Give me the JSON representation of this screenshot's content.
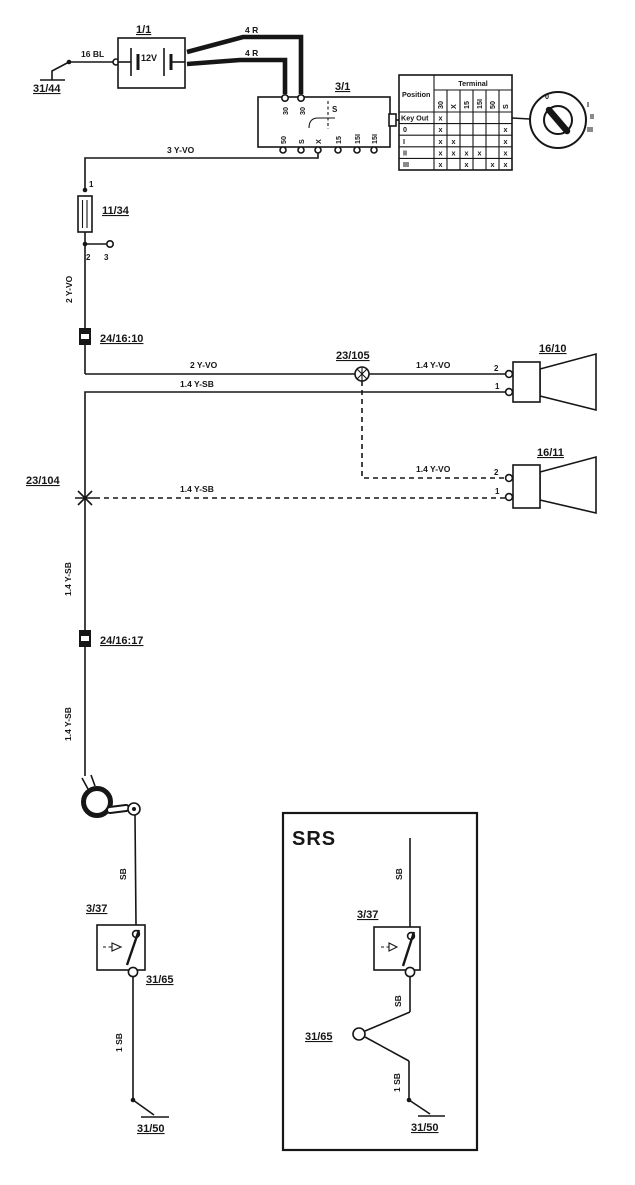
{
  "page": {
    "bg": "#ffffff",
    "ink": "#161616"
  },
  "labels": {
    "ground_top_left": "31/44",
    "wire_16bl": "16 BL",
    "battery_id": "1/1",
    "battery_voltage": "12V",
    "wire_4r_upper": "4 R",
    "wire_4r_lower": "4 R",
    "ignition_id": "3/1",
    "ignition_top_terminals": [
      "30",
      "30"
    ],
    "ignition_internal_s": "S",
    "ignition_bottom_terminals": [
      "50",
      "S",
      "X",
      "15",
      "15I",
      "15I"
    ],
    "wire_3yvo": "3 Y-VO",
    "fuse_terminal_1": "1",
    "fuse_id": "11/34",
    "fuse_terminal_2": "2",
    "fuse_terminal_3": "3",
    "wire_2yvo_vertical": "2 Y-VO",
    "connector_24_16_10": "24/16:10",
    "wire_2yvo": "2 Y-VO",
    "splice_23_105": "23/105",
    "wire_14yvo_solid": "1.4 Y-VO",
    "horn_upper_id": "16/10",
    "horn_upper_terminal_2": "2",
    "horn_upper_terminal_1": "1",
    "wire_14ysb_solid": "1.4 Y-SB",
    "wire_14yvo_dashed": "1.4 Y-VO",
    "horn_lower_id": "16/11",
    "horn_lower_terminal_2": "2",
    "horn_lower_terminal_1": "1",
    "splice_23_104": "23/104",
    "wire_14ysb_dashed": "1.4 Y-SB",
    "wire_14ysb_upper": "1.4 Y-SB",
    "connector_24_16_17": "24/16:17",
    "wire_14ysb_lower": "1.4 Y-SB",
    "wire_sb_left": "SB",
    "switch_left_id": "3/37",
    "connector_31_65_left": "31/65",
    "wire_1sb_left": "1 SB",
    "ground_bottom_left": "31/50"
  },
  "table": {
    "position_header": "Position",
    "terminal_header": "Terminal",
    "columns": [
      "30",
      "X",
      "15",
      "15I",
      "50",
      "S"
    ],
    "rows": [
      {
        "label": "Key Out",
        "marks": [
          "x",
          "",
          "",
          "",
          "",
          ""
        ]
      },
      {
        "label": "0",
        "marks": [
          "x",
          "",
          "",
          "",
          "",
          "x"
        ]
      },
      {
        "label": "I",
        "marks": [
          "x",
          "x",
          "",
          "",
          "",
          "x"
        ]
      },
      {
        "label": "II",
        "marks": [
          "x",
          "x",
          "x",
          "x",
          "",
          "x"
        ]
      },
      {
        "label": "III",
        "marks": [
          "x",
          "",
          "x",
          "",
          "x",
          "x"
        ]
      }
    ]
  },
  "key_lock": {
    "positions": [
      "0",
      "I",
      "II",
      "III"
    ]
  },
  "srs": {
    "title": "SRS",
    "wire_sb_top": "SB",
    "switch_id": "3/37",
    "wire_sb_bottom": "SB",
    "connector_31_65": "31/65",
    "wire_1sb": "1 SB",
    "ground": "31/50"
  }
}
